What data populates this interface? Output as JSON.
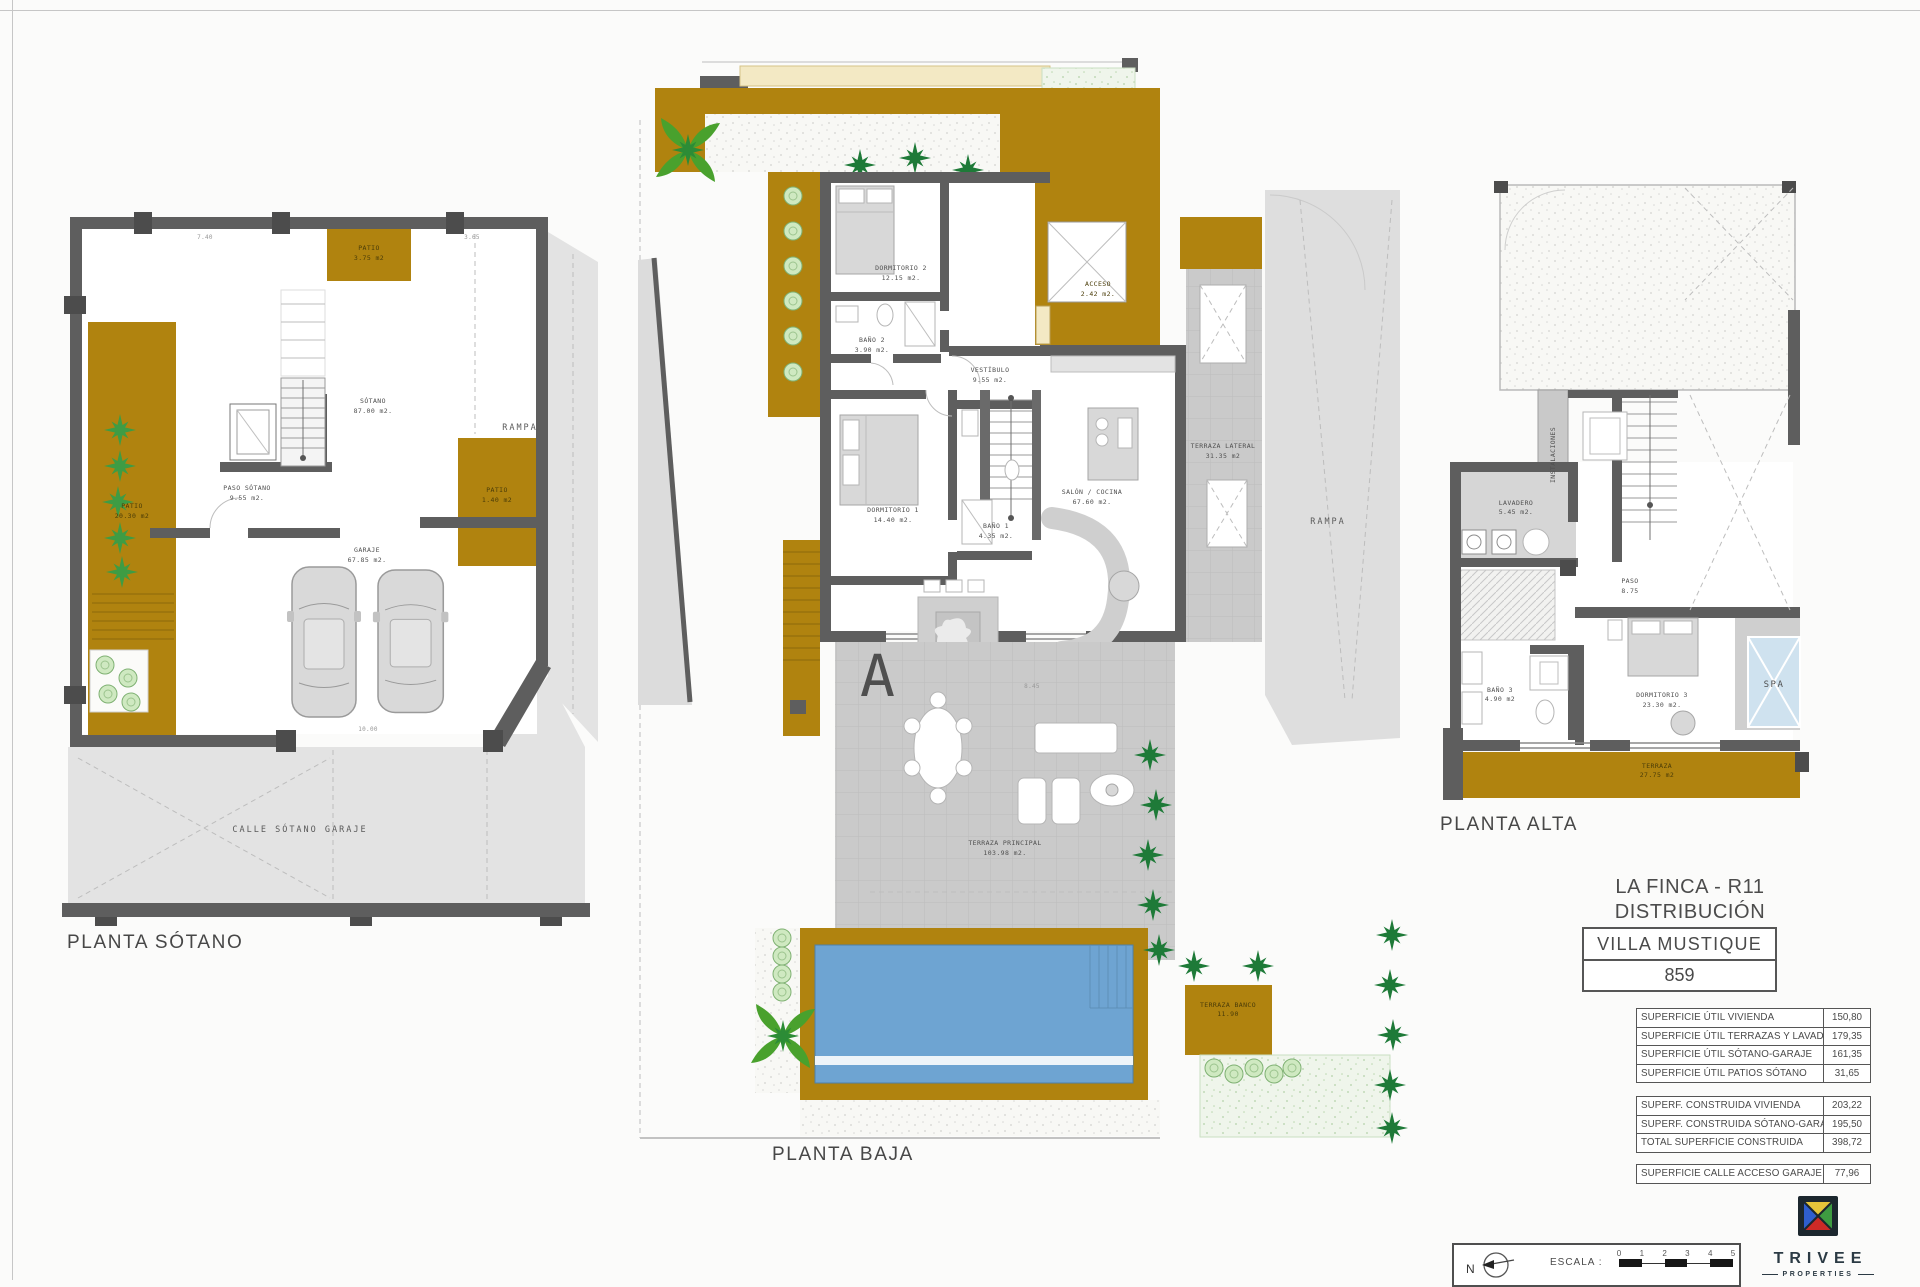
{
  "watermark": {
    "letter": "A"
  },
  "palette": {
    "ochre": "#b0830f",
    "wall_gray": "#5e5e5e",
    "terrace_gray": "#cacaca",
    "light_gray": "#e3e3e3",
    "pool_blue": "#6ea4d2",
    "spa_blue": "#cfe2ef",
    "palm_green": "#1e7a38",
    "garden_green": "#eff5eb"
  },
  "plans": {
    "sotano": {
      "label": "PLANTA SÓTANO",
      "rooms": {
        "patio_top": {
          "name": "PATIO",
          "area": "3.75 m2"
        },
        "sotano": {
          "name": "SÓTANO",
          "area": "87.00 m2."
        },
        "paso": {
          "name": "PASO SÓTANO",
          "area": "9.55 m2."
        },
        "patio_left": {
          "name": "PATIO",
          "area": "20.30 m2"
        },
        "patio_right": {
          "name": "PATIO",
          "area": "1.40 m2"
        },
        "garaje": {
          "name": "GARAJE",
          "area": "67.85 m2."
        },
        "calle": {
          "name": "CALLE SÓTANO GARAJE"
        },
        "rampa": {
          "name": "RAMPA"
        }
      },
      "dims": {
        "d1": "7.40",
        "d2": "3.65",
        "d3": "10.00"
      }
    },
    "baja": {
      "label": "PLANTA BAJA",
      "rooms": {
        "dorm2": {
          "name": "DORMITORIO 2",
          "area": "12.15 m2."
        },
        "bano2": {
          "name": "BAÑO 2",
          "area": "3.90 m2."
        },
        "vestibulo": {
          "name": "VESTÍBULO",
          "area": "9.55 m2."
        },
        "acceso": {
          "name": "ACCESO",
          "area": "2.42 m2."
        },
        "dorm1": {
          "name": "DORMITORIO 1",
          "area": "14.40 m2."
        },
        "bano1": {
          "name": "BAÑO 1",
          "area": "4.35 m2."
        },
        "salon": {
          "name": "SALÓN / COCINA",
          "area": "67.60 m2."
        },
        "terraza_lateral": {
          "name": "TERRAZA LATERAL",
          "area": "31.35 m2"
        },
        "terraza_principal": {
          "name": "TERRAZA PRINCIPAL",
          "area": "103.98 m2."
        },
        "terraza_banco": {
          "name": "TERRAZA BANCO",
          "area": "11.90"
        },
        "rampa": {
          "name": "RAMPA"
        }
      },
      "dims": {
        "d1": "8.45"
      }
    },
    "alta": {
      "label": "PLANTA ALTA",
      "rooms": {
        "lavadero": {
          "name": "LAVADERO",
          "area": "5.45 m2."
        },
        "instalaciones": {
          "name": "INSTALACIONES"
        },
        "paso": {
          "name": "PASO",
          "area": "8.75"
        },
        "bano3": {
          "name": "BAÑO 3",
          "area": "4.90 m2"
        },
        "dorm3": {
          "name": "DORMITORIO 3",
          "area": "23.30 m2."
        },
        "spa": {
          "name": "SPA"
        },
        "terraza": {
          "name": "TERRAZA",
          "area": "27.75 m2"
        }
      }
    }
  },
  "title_block": {
    "project": "LA FINCA - R11",
    "subtitle": "DISTRIBUCIÓN",
    "villa": "VILLA  MUSTIQUE",
    "number": "859"
  },
  "tables": {
    "util": {
      "rows": [
        {
          "label": "SUPERFICIE ÚTIL VIVIENDA",
          "value": "150,80"
        },
        {
          "label": "SUPERFICIE ÚTIL TERRAZAS Y LAVADERO",
          "value": "179,35"
        },
        {
          "label": "SUPERFICIE ÚTIL SÓTANO-GARAJE",
          "value": "161,35"
        },
        {
          "label": "SUPERFICIE ÚTIL PATIOS SÓTANO",
          "value": "31,65"
        }
      ]
    },
    "construida": {
      "rows": [
        {
          "label": "SUPERF. CONSTRUIDA VIVIENDA",
          "value": "203,22"
        },
        {
          "label": "SUPERF. CONSTRUIDA SÓTANO-GARAJE",
          "value": "195,50"
        },
        {
          "label": "TOTAL SUPERFICIE CONSTRUIDA",
          "value": "398,72"
        }
      ]
    },
    "calle": {
      "rows": [
        {
          "label": "SUPERFICIE CALLE ACCESO GARAJE",
          "value": "77,96"
        }
      ]
    }
  },
  "scale_bar": {
    "north": "N",
    "label": "ESCALA :",
    "ticks": [
      "0",
      "1",
      "2",
      "3",
      "4",
      "5"
    ]
  },
  "logo": {
    "name": "TRIVEE",
    "tagline": "PROPERTIES",
    "colors": {
      "yellow": "#e5c53a",
      "green": "#3e9b41",
      "red": "#cd2a26",
      "blue": "#2f5ecf",
      "frame": "#1c272e"
    }
  }
}
